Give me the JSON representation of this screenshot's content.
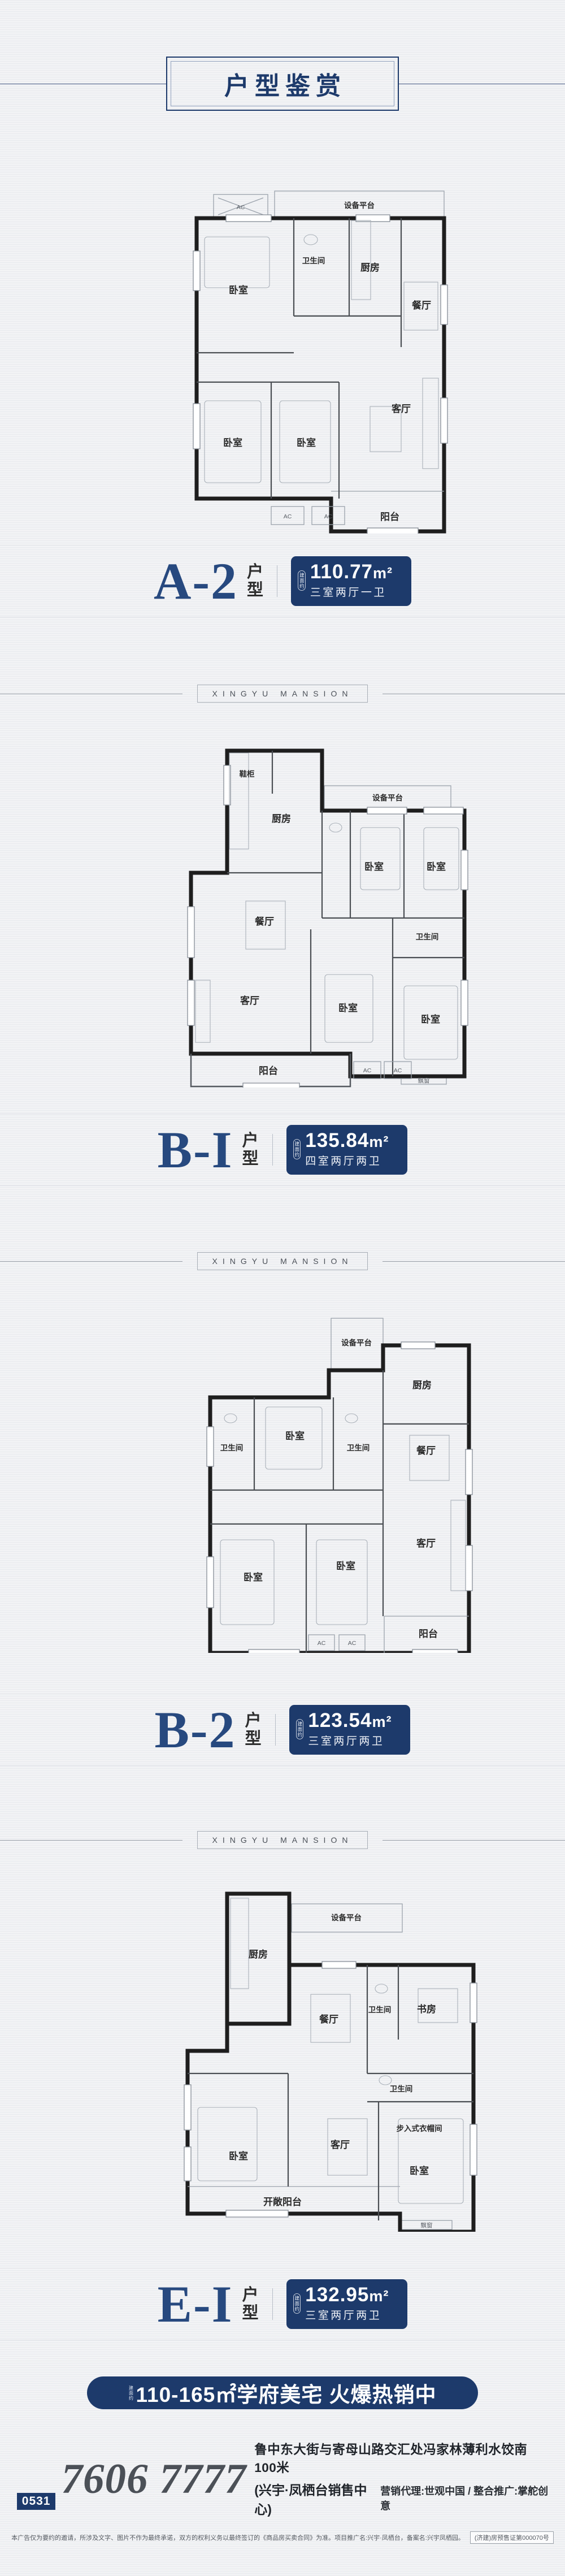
{
  "colors": {
    "navy": "#1d3a6b",
    "letterBlue": "#27497f",
    "phoneGray": "#4b5057",
    "paper": "#f2f3f5"
  },
  "header": {
    "title": "户型鉴赏"
  },
  "divider": {
    "text": "XINGYU MANSION"
  },
  "plans": [
    {
      "name": "A-2",
      "suffix": "户型",
      "area_prefix": "建面约",
      "area": "110.77",
      "area_unit": "m²",
      "rooms_text": "三室两厅一卫",
      "rooms": {
        "equip": "设备平台",
        "ac_top": "AC",
        "bed1": "卧室",
        "bath": "卫生间",
        "kitchen": "厨房",
        "dining": "餐厅",
        "living": "客厅",
        "bed2": "卧室",
        "bed3": "卧室",
        "balcony": "阳台",
        "ac1": "AC",
        "ac2": "AC"
      }
    },
    {
      "name": "B-I",
      "suffix": "户型",
      "area_prefix": "建面约",
      "area": "135.84",
      "area_unit": "m²",
      "rooms_text": "四室两厅两卫",
      "rooms": {
        "shoe": "鞋柜",
        "kitchen": "厨房",
        "equip": "设备平台",
        "bed1": "卧室",
        "bed2": "卧室",
        "dining": "餐厅",
        "bath": "卫生间",
        "living": "客厅",
        "bed3": "卧室",
        "bed4": "卧室",
        "balcony": "阳台",
        "bay": "飘窗",
        "ac1": "AC",
        "ac2": "AC"
      }
    },
    {
      "name": "B-2",
      "suffix": "户型",
      "area_prefix": "建面约",
      "area": "123.54",
      "area_unit": "m²",
      "rooms_text": "三室两厅两卫",
      "rooms": {
        "equip": "设备平台",
        "kitchen": "厨房",
        "bath1": "卫生间",
        "bed1": "卧室",
        "bath2": "卫生间",
        "dining": "餐厅",
        "living": "客厅",
        "bed2": "卧室",
        "bed3": "卧室",
        "balcony": "阳台",
        "ac1": "AC",
        "ac2": "AC"
      }
    },
    {
      "name": "E-I",
      "suffix": "户型",
      "area_prefix": "建面约",
      "area": "132.95",
      "area_unit": "m²",
      "rooms_text": "三室两厅两卫",
      "rooms": {
        "equip": "设备平台",
        "kitchen": "厨房",
        "dining": "餐厅",
        "bath1": "卫生间",
        "study": "书房",
        "bath2": "卫生间",
        "closet": "步入式衣帽间",
        "bed1": "卧室",
        "living": "客厅",
        "bed2": "卧室",
        "balcony": "开敞阳台",
        "bay": "飘窗"
      }
    }
  ],
  "banner": {
    "prefix": "建面约",
    "text": "110-165㎡学府美宅 火爆热销中"
  },
  "footer": {
    "area_code": "0531",
    "phone": "7606 7777",
    "address_line1": "鲁中东大街与寄母山路交汇处冯家林薄利水饺南100米",
    "address_line2_strong": "(兴宇·凤栖台销售中心)",
    "address_line2_rest": "营销代理:世观中国 / 整合推广:掌舵创意",
    "disclaimer": "本广告仅为要约的邀请，所涉及文字、图片不作为最终承诺，双方的权利义务以最终签订的《商品房买卖合同》为准。项目推广名:兴宇·凤栖台，备案名:兴宇凤栖园。",
    "license": "(济建)房预售证第000070号"
  }
}
